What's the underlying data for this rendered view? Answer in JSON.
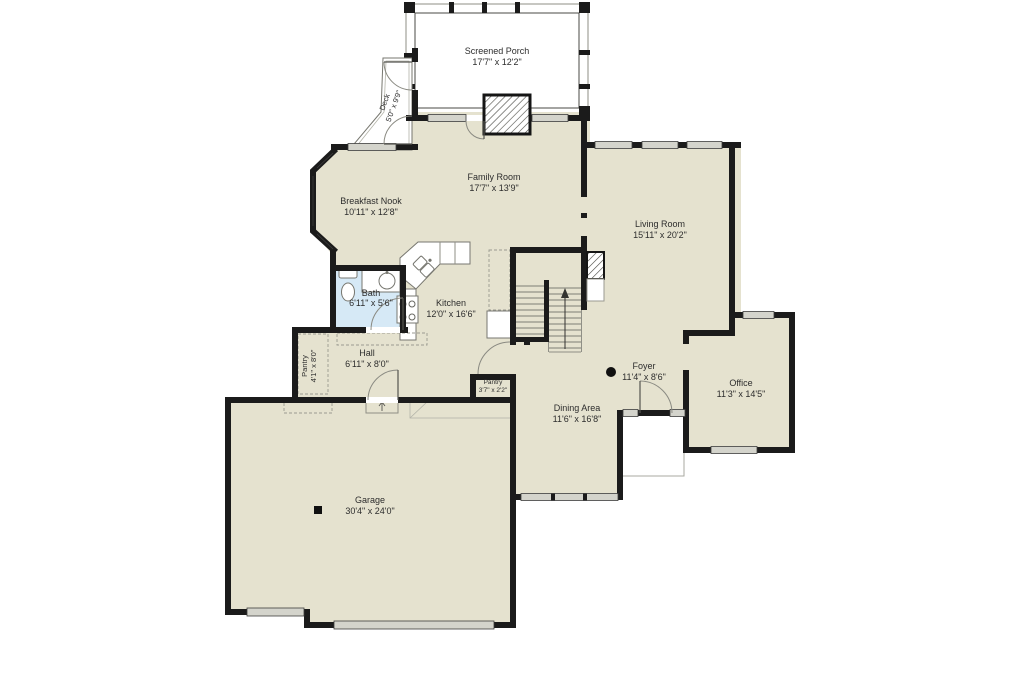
{
  "colors": {
    "background": "#ffffff",
    "floor": "#e5e2cf",
    "wall": "#1b1b1b",
    "bath_floor": "#d6e9f6",
    "window": "#d4d4cc",
    "porch_band": "#ebebe3",
    "marker": "#101010"
  },
  "rooms": {
    "screened_porch": {
      "name": "Screened Porch",
      "dims": "17'7\" x 12'2\""
    },
    "deck": {
      "name": "Deck",
      "dims": "5'0\" x 9'9\""
    },
    "family_room": {
      "name": "Family Room",
      "dims": "17'7\" x 13'9\""
    },
    "breakfast_nook": {
      "name": "Breakfast Nook",
      "dims": "10'11\" x 12'8\""
    },
    "living_room": {
      "name": "Living Room",
      "dims": "15'11\" x 20'2\""
    },
    "bath": {
      "name": "Bath",
      "dims": "6'11\" x 5'6\""
    },
    "kitchen": {
      "name": "Kitchen",
      "dims": "12'0\" x 16'6\""
    },
    "hall": {
      "name": "Hall",
      "dims": "6'11\" x 8'0\""
    },
    "pantry": {
      "name": "Pantry",
      "dims": "4'1\" x 8'0\""
    },
    "pantry_small": {
      "name": "Pantry",
      "dims": "3'7\" x 2'2\""
    },
    "foyer": {
      "name": "Foyer",
      "dims": "11'4\" x 8'6\""
    },
    "dining_area": {
      "name": "Dining Area",
      "dims": "11'6\" x 16'8\""
    },
    "office": {
      "name": "Office",
      "dims": "11'3\" x 14'5\""
    },
    "garage": {
      "name": "Garage",
      "dims": "30'4\" x 24'0\""
    }
  },
  "markers": {
    "foyer_dot": "photo-point-marker",
    "garage_square": "post-marker"
  }
}
